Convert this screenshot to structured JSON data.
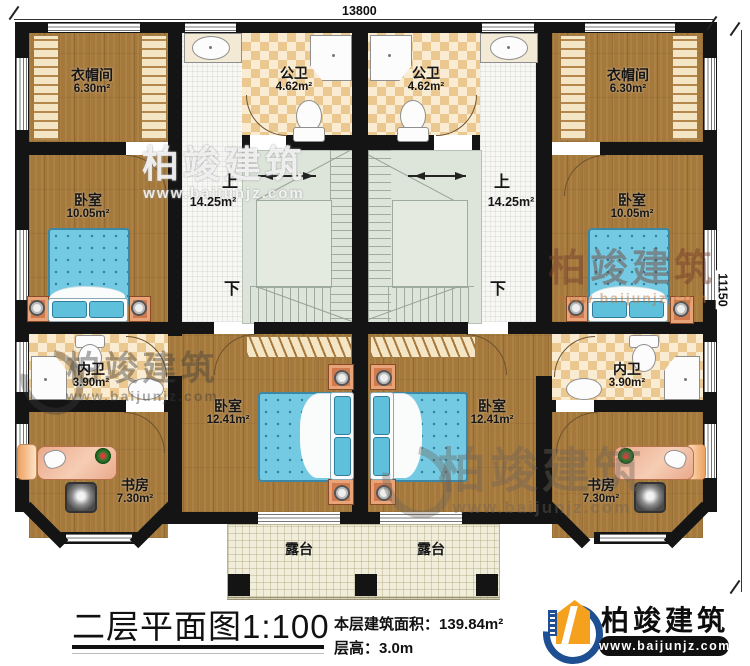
{
  "dimensions": {
    "width_top": "13800",
    "height_right": "11150"
  },
  "rooms": {
    "cloak_left": {
      "name": "衣帽间",
      "area": "6.30m²"
    },
    "cloak_right": {
      "name": "衣帽间",
      "area": "6.30m²"
    },
    "pub_bath_left": {
      "name": "公卫",
      "area": "4.62m²"
    },
    "pub_bath_right": {
      "name": "公卫",
      "area": "4.62m²"
    },
    "bedroom_small_left": {
      "name": "卧室",
      "area": "10.05m²"
    },
    "bedroom_small_right": {
      "name": "卧室",
      "area": "10.05m²"
    },
    "stair_left": {
      "up": "上",
      "down": "下",
      "area": "14.25m²"
    },
    "stair_right": {
      "up": "上",
      "down": "下",
      "area": "14.25m²"
    },
    "inner_bath_left": {
      "name": "内卫",
      "area": "3.90m²"
    },
    "inner_bath_right": {
      "name": "内卫",
      "area": "3.90m²"
    },
    "bedroom_large_left": {
      "name": "卧室",
      "area": "12.41m²"
    },
    "bedroom_large_right": {
      "name": "卧室",
      "area": "12.41m²"
    },
    "study_left": {
      "name": "书房",
      "area": "7.30m²"
    },
    "study_right": {
      "name": "书房",
      "area": "7.30m²"
    },
    "terrace_left": {
      "name": "露台"
    },
    "terrace_right": {
      "name": "露台"
    }
  },
  "footer": {
    "title": "二层平面图",
    "scale": "1:100",
    "area_label": "本层建筑面积：",
    "area_value": "139.84m²",
    "height_label": "层高：",
    "height_value": "3.0m"
  },
  "logo": {
    "company": "柏竣建筑",
    "website": "www.baijunjz.com"
  },
  "watermark": {
    "text": "柏竣建筑",
    "website": "www.baijunjz.com"
  },
  "colors": {
    "wall": "#141414",
    "wood": "#a5793c",
    "accent_blue": "#1d4f92",
    "accent_orange": "#f6a11d"
  }
}
